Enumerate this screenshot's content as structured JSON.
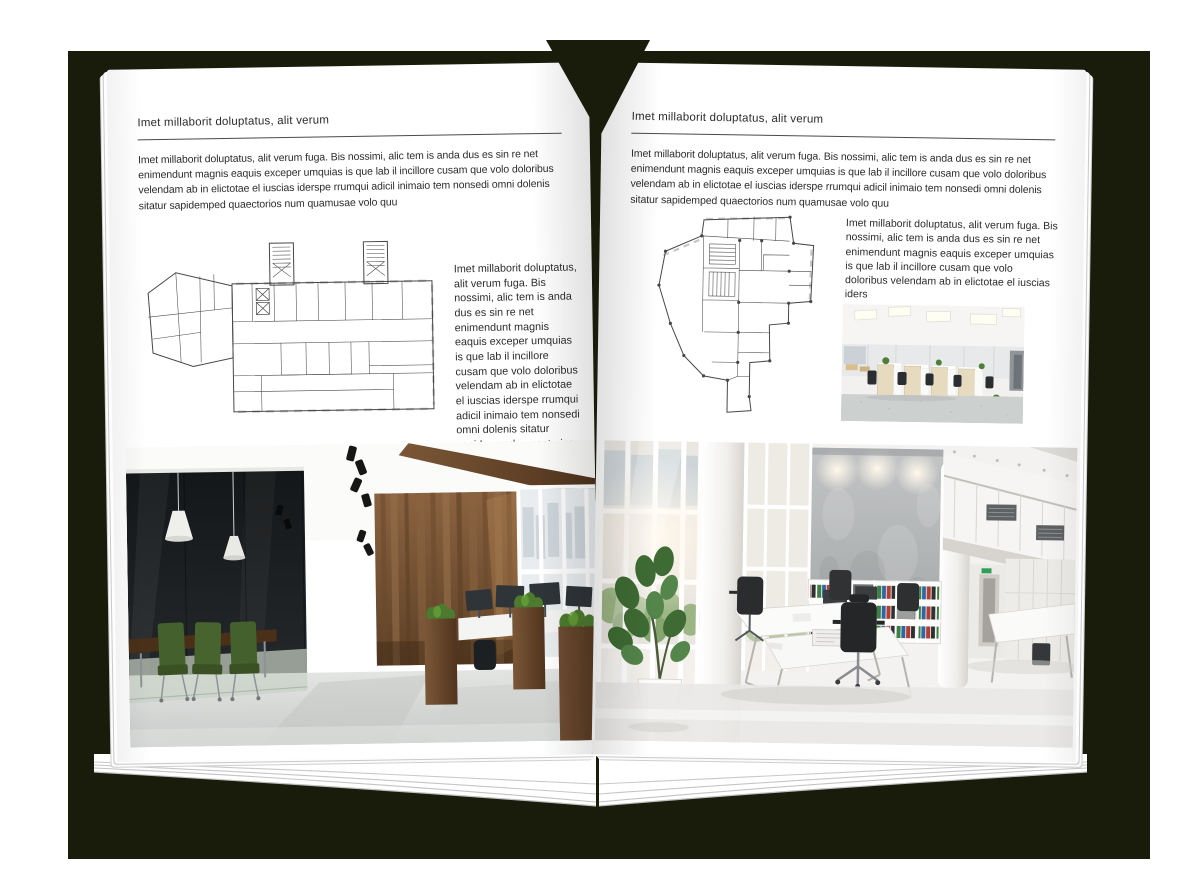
{
  "scene": {
    "backdrop_color": "#1a1c0b",
    "page_color": "#ffffff"
  },
  "left_page": {
    "header": "Imet millaborit doluptatus, alit verum",
    "intro": "Imet millaborit doluptatus, alit verum fuga. Bis nossimi, alic tem is anda dus es sin re net enimendunt magnis eaquis exceper umquias is que lab il incillore cusam que volo doloribus velendam ab in elictotae el iuscias iderspe rrumqui adicil inimaio tem nonsedi omni dolenis sitatur sapidemped quaectorios num quamusae volo quu",
    "side_text": "Imet millaborit doluptatus, alit verum fuga. Bis nossimi, alic tem is anda dus es sin re net enimendunt magnis eaquis exceper umquias is que lab il incillore cusam que volo doloribus velendam ab in elictotae el iuscias iderspe rrumqui adicil inimaio tem nonsedi omni dolenis sitatur sapidemped quaectorios num quamusae volo quu"
  },
  "right_page": {
    "header": "Imet millaborit doluptatus, alit verum",
    "intro": "Imet millaborit doluptatus, alit verum fuga. Bis nossimi, alic tem is anda dus es sin re net enimendunt magnis eaquis exceper umquias is que lab il incillore cusam que volo doloribus velendam ab in elictotae el iuscias iderspe rrumqui adicil inimaio tem nonsedi omni dolenis sitatur sapidemped quaectorios num quamusae volo quu",
    "side_text": "Imet millaborit doluptatus, alit verum fuga. Bis nossimi, alic tem is anda dus es sin re net enimendunt magnis eaquis exceper umquias is que lab il incillore cusam que volo doloribus velendam ab in elictotae el iuscias iders"
  }
}
